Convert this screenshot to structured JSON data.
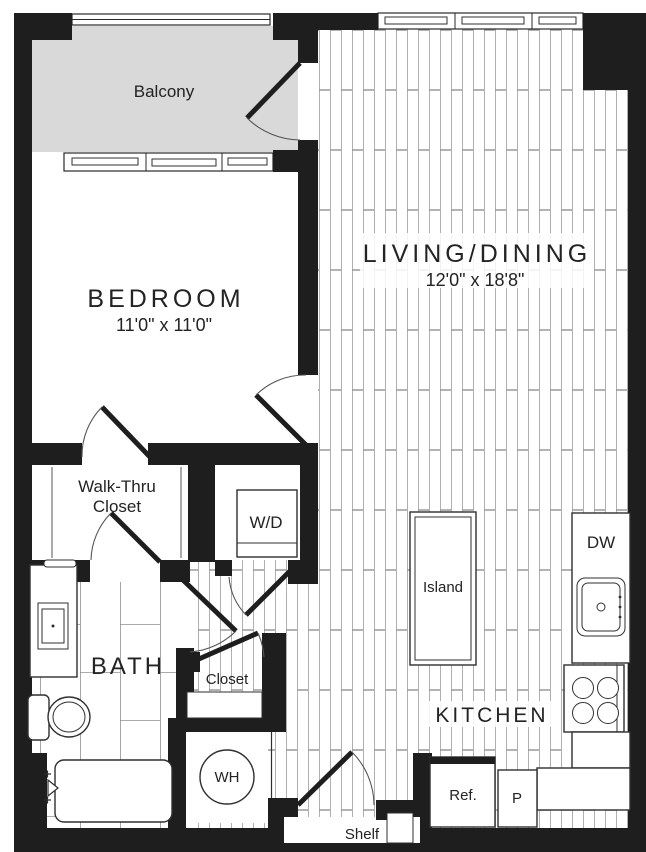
{
  "plan": {
    "rooms": {
      "balcony": {
        "label": "Balcony"
      },
      "living_dining": {
        "label": "LIVING/DINING",
        "dimensions": "12'0\" x 18'8\""
      },
      "bedroom": {
        "label": "BEDROOM",
        "dimensions": "11'0\" x 11'0\""
      },
      "walk_thru_closet": {
        "line1": "Walk-Thru",
        "line2": "Closet"
      },
      "bath": {
        "label": "BATH"
      },
      "closet": {
        "label": "Closet"
      },
      "kitchen": {
        "label": "KITCHEN"
      }
    },
    "fixtures": {
      "washer_dryer": {
        "label": "W/D"
      },
      "water_heater": {
        "label": "WH"
      },
      "island": {
        "label": "Island"
      },
      "dishwasher": {
        "label": "DW"
      },
      "refrigerator": {
        "label": "Ref."
      },
      "pantry": {
        "label": "P"
      },
      "shelf": {
        "label": "Shelf"
      }
    },
    "colors": {
      "wall": "#1e1e1e",
      "balcony_floor": "#d9d9d9",
      "floor_line": "#a8a8a8",
      "tile_line": "#909090",
      "text": "#232323"
    }
  }
}
